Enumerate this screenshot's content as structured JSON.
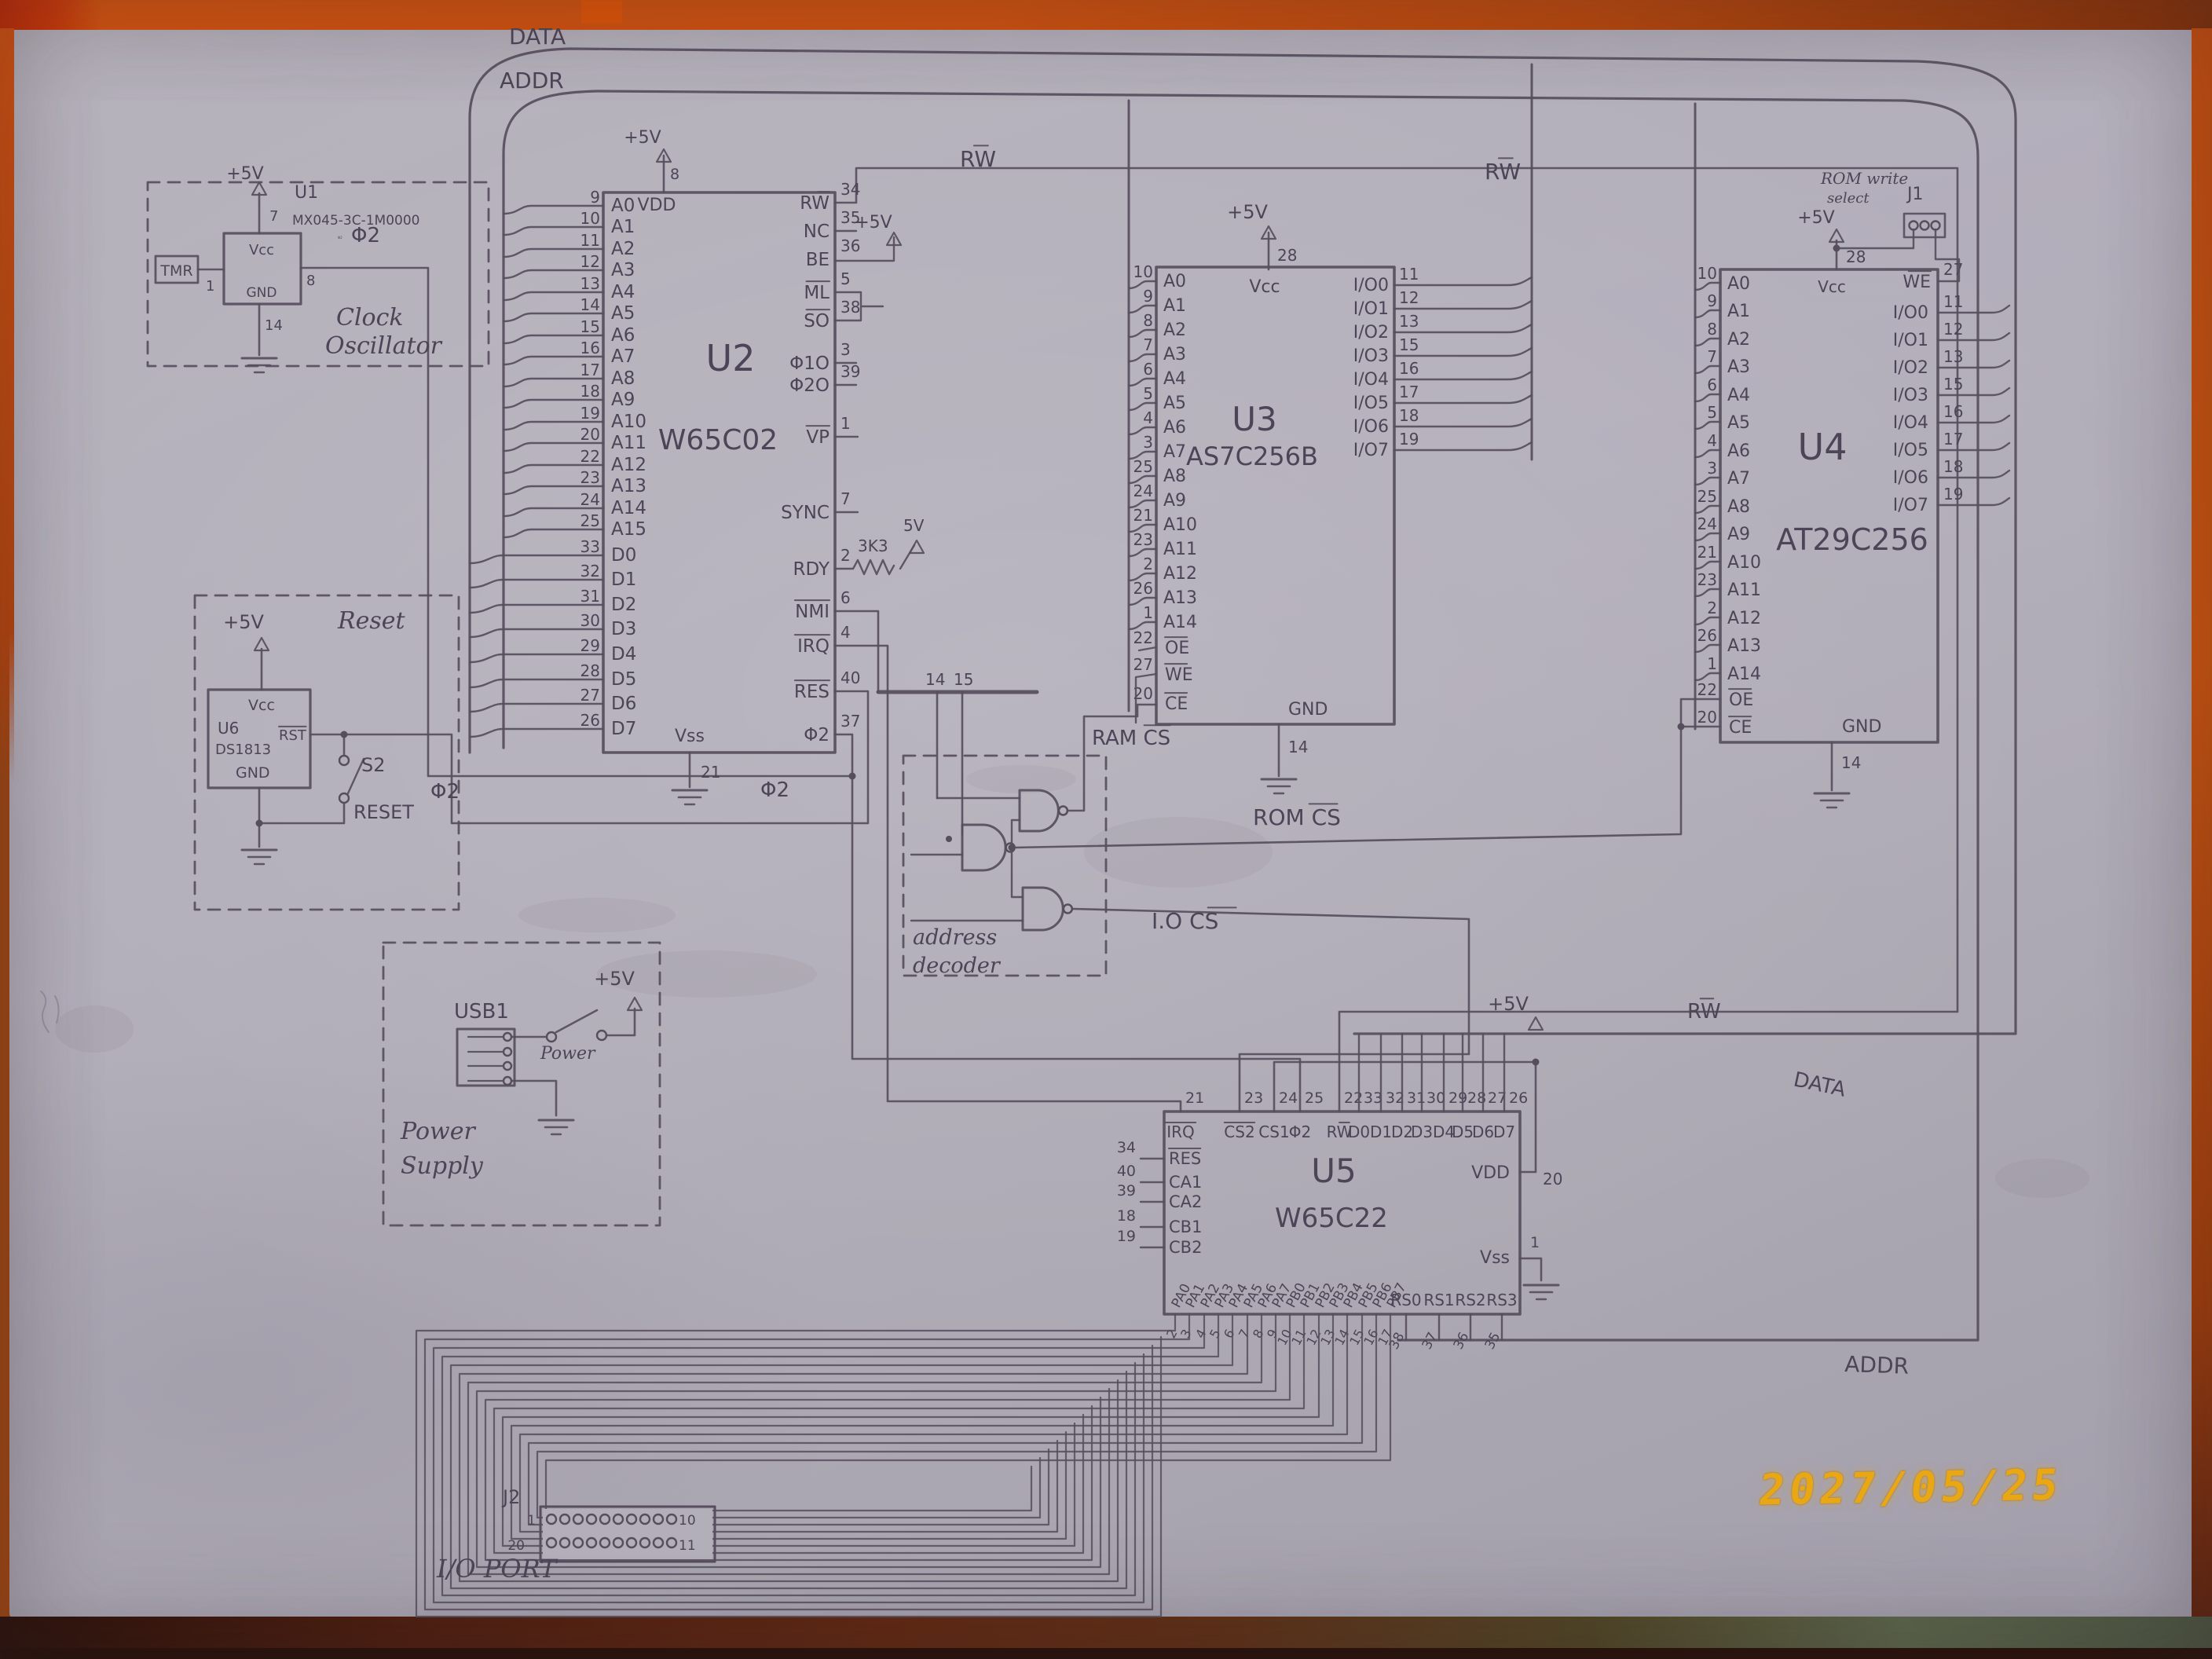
{
  "photo": {
    "date_stamp": "2027/05/25"
  },
  "buses": {
    "data_top": "DATA",
    "addr_top": "ADDR",
    "data_right": "DATA",
    "addr_right": "ADDR",
    "rw_u2": {
      "pre": "R",
      "bar": "W"
    },
    "rw_u3": {
      "pre": "R",
      "bar": "W"
    },
    "rw_u4": {
      "pre": "R",
      "bar": "W"
    },
    "rw_bottom": {
      "pre": "R",
      "bar": "W"
    },
    "phi2_osc": "Φ2",
    "phi2_mid": "Φ2",
    "phi2_u2": "Φ2",
    "w14": "14",
    "w15": "15"
  },
  "clock": {
    "ref": "U1",
    "part": "MX045-3C-1M0000",
    "phi2": "Φ2",
    "tmr": "TMR",
    "vcc": "Vcc",
    "gnd": "GND",
    "plus5": "+5V",
    "pin_vcc": "7",
    "pin_gnd": "14",
    "pin_in": "1",
    "pin_out": "8",
    "title1": "Clock",
    "title2": "Oscillator"
  },
  "reset": {
    "title": "Reset",
    "plus5": "+5V",
    "vcc": "Vcc",
    "ref": "U6",
    "part": "DS1813",
    "rst": {
      "pre": "",
      "bar": "RST"
    },
    "gnd": "GND",
    "sw": "S2",
    "label": "RESET"
  },
  "power": {
    "usb": "USB1",
    "switch": "Power",
    "plus5": "+5V",
    "title1": "Power",
    "title2": "Supply"
  },
  "decoder": {
    "line1": "address",
    "line2": "decoder",
    "ram_cs": {
      "pre": "RAM ",
      "bar": "CS"
    },
    "rom_cs": {
      "pre": "ROM ",
      "bar": "CS"
    },
    "io_cs": {
      "pre": "I.O ",
      "bar": "CS"
    }
  },
  "u2": {
    "ref": "U2",
    "part": "W65C02",
    "pins_addr": [
      [
        "9",
        "A0"
      ],
      [
        "10",
        "A1"
      ],
      [
        "11",
        "A2"
      ],
      [
        "12",
        "A3"
      ],
      [
        "13",
        "A4"
      ],
      [
        "14",
        "A5"
      ],
      [
        "15",
        "A6"
      ],
      [
        "16",
        "A7"
      ],
      [
        "17",
        "A8"
      ],
      [
        "18",
        "A9"
      ],
      [
        "19",
        "A10"
      ],
      [
        "20",
        "A11"
      ],
      [
        "22",
        "A12"
      ],
      [
        "23",
        "A13"
      ],
      [
        "24",
        "A14"
      ],
      [
        "25",
        "A15"
      ]
    ],
    "pins_data": [
      [
        "33",
        "D0"
      ],
      [
        "32",
        "D1"
      ],
      [
        "31",
        "D2"
      ],
      [
        "30",
        "D3"
      ],
      [
        "29",
        "D4"
      ],
      [
        "28",
        "D5"
      ],
      [
        "27",
        "D6"
      ],
      [
        "26",
        "D7"
      ]
    ],
    "pins_right": [
      [
        "34",
        "R",
        "W"
      ],
      [
        "35",
        "NC",
        ""
      ],
      [
        "36",
        "BE",
        ""
      ],
      [
        "5",
        "",
        "ML"
      ],
      [
        "38",
        "",
        "SO"
      ],
      [
        "3",
        "Φ1O",
        ""
      ],
      [
        "39",
        "Φ2O",
        ""
      ],
      [
        "1",
        "",
        "VP"
      ],
      [
        "7",
        "SYNC",
        ""
      ],
      [
        "2",
        "RDY",
        ""
      ],
      [
        "6",
        "",
        "NMI"
      ],
      [
        "4",
        "",
        "IRQ"
      ],
      [
        "40",
        "",
        "RES"
      ],
      [
        "37",
        "Φ2",
        ""
      ]
    ],
    "vdd": "VDD",
    "vss": "Vss",
    "pin_vdd": "8",
    "pin_vss": "21",
    "plus5": "+5V",
    "pullup": "3K3",
    "pullup_v": "5V"
  },
  "u3": {
    "ref": "U3",
    "part": "AS7C256B",
    "pins_left": [
      [
        "10",
        "A0"
      ],
      [
        "9",
        "A1"
      ],
      [
        "8",
        "A2"
      ],
      [
        "7",
        "A3"
      ],
      [
        "6",
        "A4"
      ],
      [
        "5",
        "A5"
      ],
      [
        "4",
        "A6"
      ],
      [
        "3",
        "A7"
      ],
      [
        "25",
        "A8"
      ],
      [
        "24",
        "A9"
      ],
      [
        "21",
        "A10"
      ],
      [
        "23",
        "A11"
      ],
      [
        "2",
        "A12"
      ],
      [
        "26",
        "A13"
      ],
      [
        "1",
        "A14"
      ]
    ],
    "pins_ctrl": [
      [
        "22",
        "OE"
      ],
      [
        "27",
        "WE"
      ],
      [
        "20",
        "CE"
      ]
    ],
    "pins_io": [
      [
        "11",
        "I/O0"
      ],
      [
        "12",
        "I/O1"
      ],
      [
        "13",
        "I/O2"
      ],
      [
        "15",
        "I/O3"
      ],
      [
        "16",
        "I/O4"
      ],
      [
        "17",
        "I/O5"
      ],
      [
        "18",
        "I/O6"
      ],
      [
        "19",
        "I/O7"
      ]
    ],
    "vcc": "Vcc",
    "pin_vcc": "28",
    "plus5": "+5V",
    "gnd": "GND",
    "pin_gnd": "14"
  },
  "u4": {
    "ref": "U4",
    "part": "AT29C256",
    "pins_left": [
      [
        "10",
        "A0"
      ],
      [
        "9",
        "A1"
      ],
      [
        "8",
        "A2"
      ],
      [
        "7",
        "A3"
      ],
      [
        "6",
        "A4"
      ],
      [
        "5",
        "A5"
      ],
      [
        "4",
        "A6"
      ],
      [
        "3",
        "A7"
      ],
      [
        "25",
        "A8"
      ],
      [
        "24",
        "A9"
      ],
      [
        "21",
        "A10"
      ],
      [
        "23",
        "A11"
      ],
      [
        "2",
        "A12"
      ],
      [
        "26",
        "A13"
      ],
      [
        "1",
        "A14"
      ]
    ],
    "pins_ctrl": [
      [
        "22",
        "OE"
      ],
      [
        "20",
        "CE"
      ]
    ],
    "pin_we": [
      "27",
      "WE"
    ],
    "pins_io": [
      [
        "11",
        "I/O0"
      ],
      [
        "12",
        "I/O1"
      ],
      [
        "13",
        "I/O2"
      ],
      [
        "15",
        "I/O3"
      ],
      [
        "16",
        "I/O4"
      ],
      [
        "17",
        "I/O5"
      ],
      [
        "18",
        "I/O6"
      ],
      [
        "19",
        "I/O7"
      ]
    ],
    "vcc": "Vcc",
    "pin_vcc": "28",
    "plus5": "+5V",
    "gnd": "GND",
    "pin_gnd": "14",
    "rom_write_1": "ROM write",
    "rom_write_2": "select",
    "j1": "J1"
  },
  "u5": {
    "ref": "U5",
    "part": "W65C22",
    "pins_top": [
      [
        "21",
        "",
        "IRQ"
      ],
      [
        "23",
        "",
        "CS2"
      ],
      [
        "24",
        "CS1",
        ""
      ],
      [
        "25",
        "Φ2",
        ""
      ],
      [
        "22",
        "R",
        "W"
      ],
      [
        "33",
        "D0",
        ""
      ],
      [
        "32",
        "D1",
        ""
      ],
      [
        "31",
        "D2",
        ""
      ],
      [
        "30",
        "D3",
        ""
      ],
      [
        "29",
        "D4",
        ""
      ],
      [
        "28",
        "D5",
        ""
      ],
      [
        "27",
        "D6",
        ""
      ],
      [
        "26",
        "D7",
        ""
      ]
    ],
    "pins_left": [
      [
        "34",
        "",
        "RES"
      ],
      [
        "40",
        "CA1",
        ""
      ],
      [
        "39",
        "CA2",
        ""
      ],
      [
        "18",
        "CB1",
        ""
      ],
      [
        "19",
        "CB2",
        ""
      ]
    ],
    "pins_pa": [
      [
        "2",
        "PA0"
      ],
      [
        "3",
        "PA1"
      ],
      [
        "4",
        "PA2"
      ],
      [
        "5",
        "PA3"
      ],
      [
        "6",
        "PA4"
      ],
      [
        "7",
        "PA5"
      ],
      [
        "8",
        "PA6"
      ],
      [
        "9",
        "PA7"
      ]
    ],
    "pins_pb": [
      [
        "10",
        "PB0"
      ],
      [
        "11",
        "PB1"
      ],
      [
        "12",
        "PB2"
      ],
      [
        "13",
        "PB3"
      ],
      [
        "14",
        "PB4"
      ],
      [
        "15",
        "PB5"
      ],
      [
        "16",
        "PB6"
      ],
      [
        "17",
        "PB7"
      ]
    ],
    "pins_rs": [
      [
        "38",
        "RS0"
      ],
      [
        "37",
        "RS1"
      ],
      [
        "36",
        "RS2"
      ],
      [
        "35",
        "RS3"
      ]
    ],
    "vdd": "VDD",
    "pin_vdd": "20",
    "vss": "Vss",
    "pin_vss": "1",
    "plus5": "+5V"
  },
  "j2": {
    "ref": "J2",
    "p1": "1",
    "p10": "10",
    "p20": "20",
    "p11": "11",
    "title": "I/O PORT"
  }
}
